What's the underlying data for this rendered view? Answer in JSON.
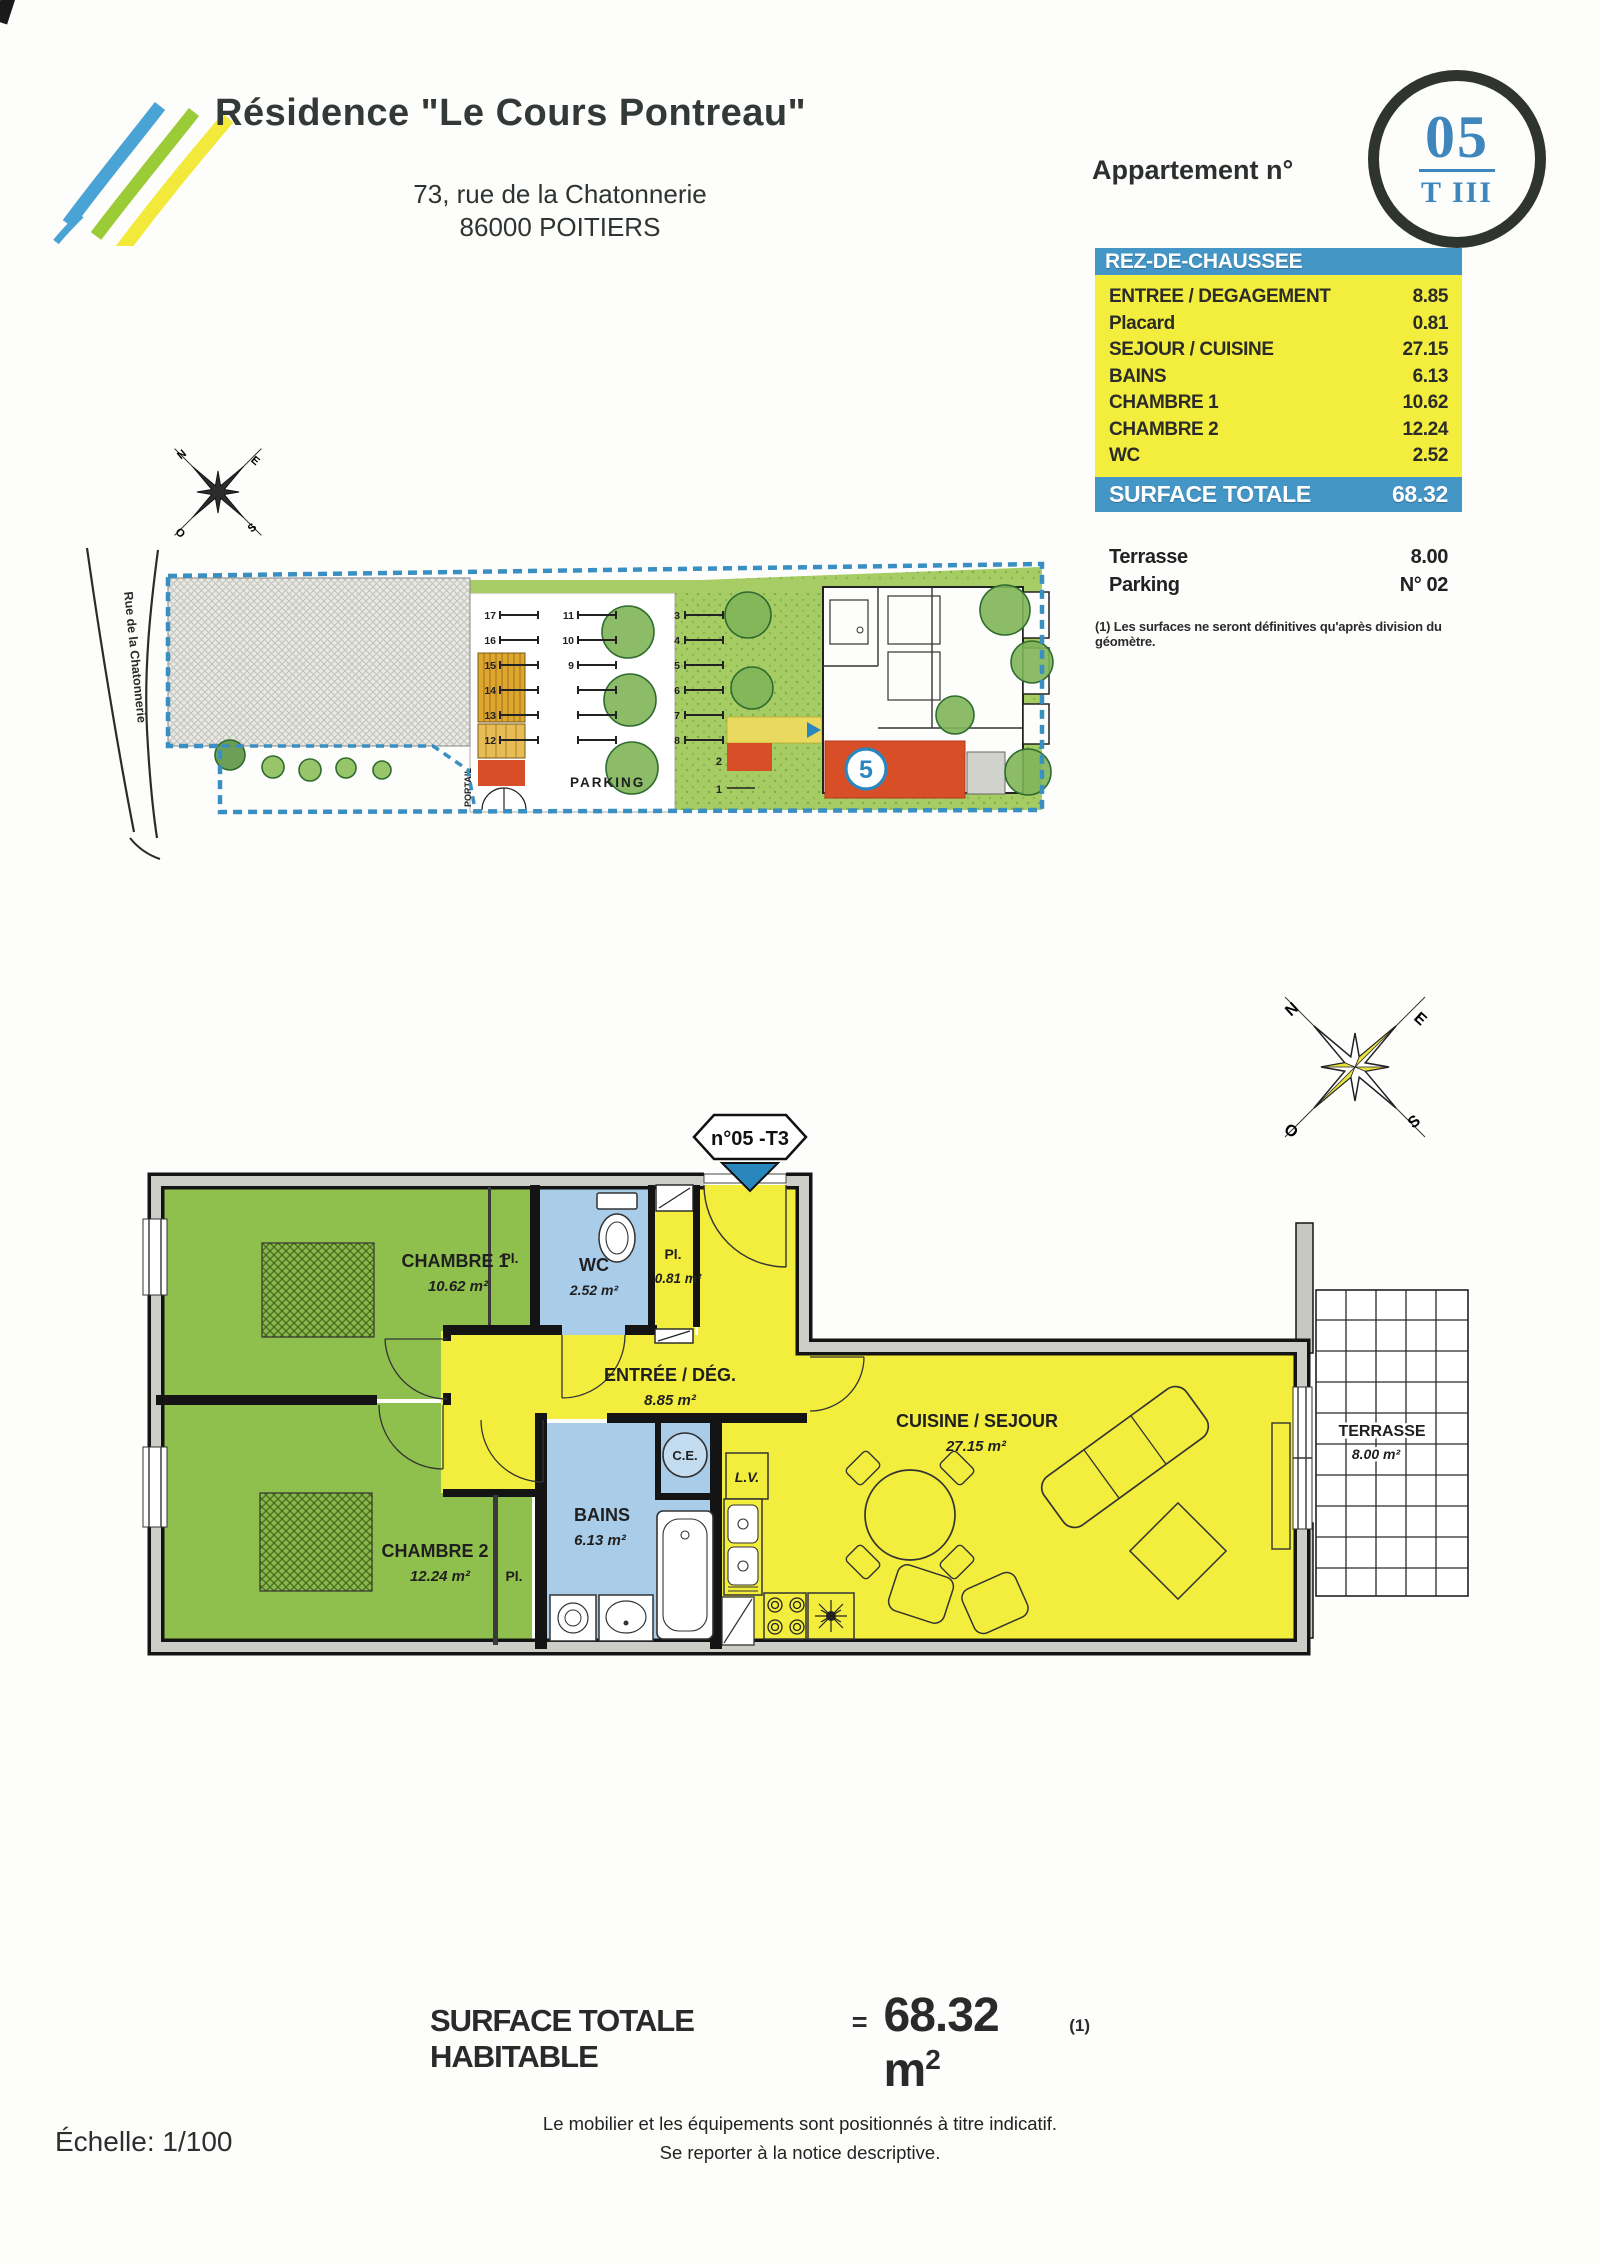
{
  "header": {
    "title": "Résidence \"Le Cours Pontreau\"",
    "address_line1": "73, rue de la Chatonnerie",
    "address_line2": "86000 POITIERS",
    "apartment_label": "Appartement n°",
    "apartment_number": "05",
    "apartment_type": "T III"
  },
  "surface_table": {
    "floor_header": "REZ-DE-CHAUSSEE",
    "rows": [
      {
        "label": "ENTREE / DEGAGEMENT",
        "value": "8.85"
      },
      {
        "label": "Placard",
        "value": "0.81"
      },
      {
        "label": "SEJOUR / CUISINE",
        "value": "27.15"
      },
      {
        "label": "BAINS",
        "value": "6.13"
      },
      {
        "label": "CHAMBRE 1",
        "value": "10.62"
      },
      {
        "label": "CHAMBRE 2",
        "value": "12.24"
      },
      {
        "label": "WC",
        "value": "2.52"
      }
    ],
    "total_label": "SURFACE TOTALE",
    "total_value": "68.32",
    "annex_rows": [
      {
        "label": "Terrasse",
        "value": "8.00"
      },
      {
        "label": "Parking",
        "value": "N° 02"
      }
    ],
    "note": "(1) Les surfaces ne seront définitives qu'après division du géomètre."
  },
  "site_plan": {
    "street_name": "Rue de la Chatonnerie",
    "parking_label": "PARKING",
    "gate_label": "PORTAIL",
    "unit_marker": "5",
    "west_numbers": [
      "17",
      "16",
      "15",
      "14",
      "13",
      "12"
    ],
    "middle_numbers": [
      "11",
      "10",
      "9"
    ],
    "east_numbers": [
      "3",
      "4",
      "5",
      "6",
      "7",
      "8"
    ],
    "gate_numbers": [
      "2",
      "1"
    ],
    "compass": {
      "n": "N",
      "e": "E",
      "s": "S",
      "o": "O"
    }
  },
  "floor_plan": {
    "unit_tag": "n°05 -T3",
    "compass": {
      "n": "N",
      "e": "E",
      "s": "S",
      "o": "O"
    },
    "rooms": {
      "chambre1": {
        "name": "CHAMBRE 1",
        "area": "10.62 m²"
      },
      "chambre2": {
        "name": "CHAMBRE 2",
        "area": "12.24 m²"
      },
      "wc": {
        "name": "WC",
        "area": "2.52 m²"
      },
      "placard": {
        "name": "Pl.",
        "area": "0.81 m²"
      },
      "entree": {
        "name": "ENTRÉE / DÉG.",
        "area": "8.85 m²"
      },
      "bains": {
        "name": "BAINS",
        "area": "6.13 m²"
      },
      "sejour": {
        "name": "CUISINE / SEJOUR",
        "area": "27.15 m²"
      },
      "terrasse": {
        "name": "TERRASSE",
        "area": "8.00 m²"
      }
    },
    "labels": {
      "pl_chambre1": "Pl.",
      "pl_chambre2": "Pl.",
      "ce": "C.E.",
      "lv": "L.V."
    }
  },
  "summary": {
    "label": "SURFACE TOTALE HABITABLE",
    "equals": "=",
    "value": "68.32 m",
    "value_sup": "2",
    "ref": "(1)"
  },
  "footer": {
    "scale": "Échelle: 1/100",
    "note_line1": "Le mobilier et les équipements sont positionnés à titre indicatif.",
    "note_line2": "Se reporter à la notice descriptive."
  },
  "colors": {
    "accent_blue": "#4496c6",
    "highlight_yellow": "#f3ee3e",
    "room_green": "#8fbf4d",
    "room_blue": "#a9cce9",
    "wall_gray": "#c8c8c2",
    "marker_red": "#d84e26",
    "badge_blue": "#3e86bb",
    "logo_blue": "#4aa3d5",
    "logo_green": "#9bcb36",
    "logo_yellow": "#f2e93a"
  }
}
